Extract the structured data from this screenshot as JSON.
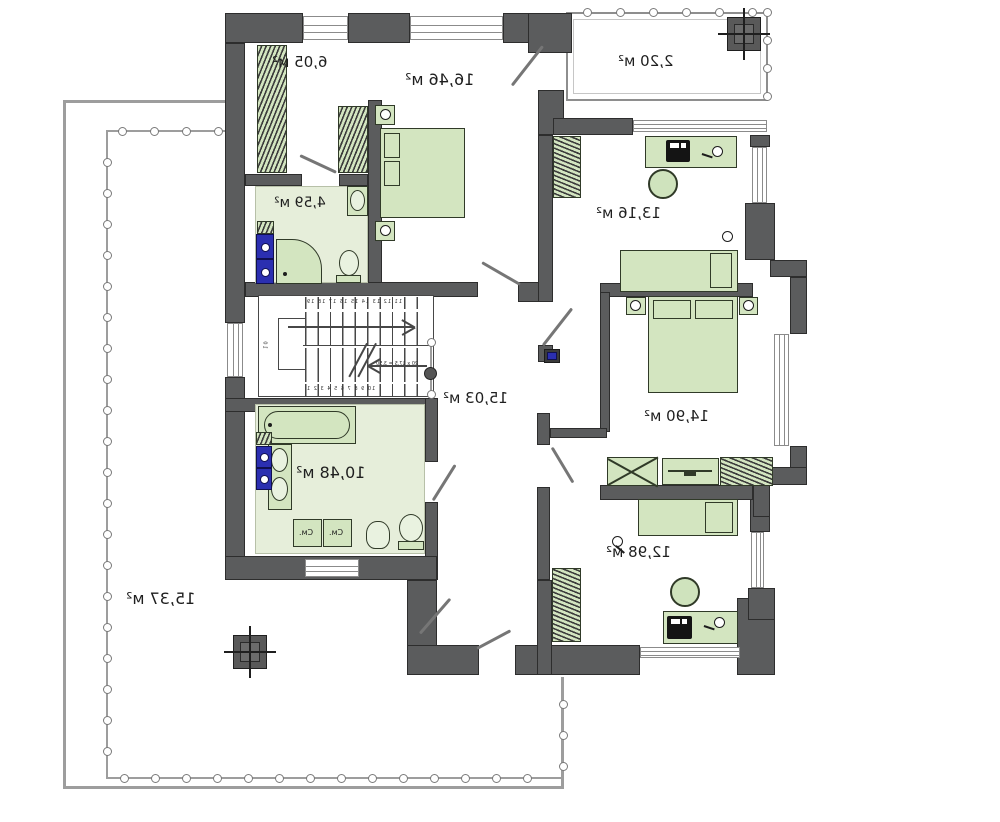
{
  "plan": {
    "title": "second floor plan",
    "rooms": [
      {
        "name": "wardrobe",
        "area": "6,05 м²"
      },
      {
        "name": "bedroom-top",
        "area": "16,46 м²"
      },
      {
        "name": "balcony",
        "area": "2,20 м²"
      },
      {
        "name": "bathroom-small",
        "area": "4,59 м²"
      },
      {
        "name": "bedroom-right-top",
        "area": "13,16 м²"
      },
      {
        "name": "hall",
        "area": "15,03 м²"
      },
      {
        "name": "bedroom-right-middle",
        "area": "14,90 м²"
      },
      {
        "name": "bathroom-main",
        "area": "10,48 м²"
      },
      {
        "name": "bedroom-right-bottom",
        "area": "12,98 м²"
      },
      {
        "name": "terrace",
        "area": "15,37 м²"
      }
    ],
    "labels": {
      "washer_box": "См."
    },
    "stairs": {
      "numbers_top": "11 12 13 14 15 16 17 18 19",
      "numbers_bottom": "10 9 8 7 6 5 4 3 2 1",
      "annotation": "20 х 17,5 = 3,50",
      "side_note": "10"
    },
    "colors": {
      "wall": "#5b5c5d",
      "furniture": "#d3e5c0",
      "bath_floor": "#e6eeda",
      "appliance_blue": "#2b2fb0"
    }
  }
}
